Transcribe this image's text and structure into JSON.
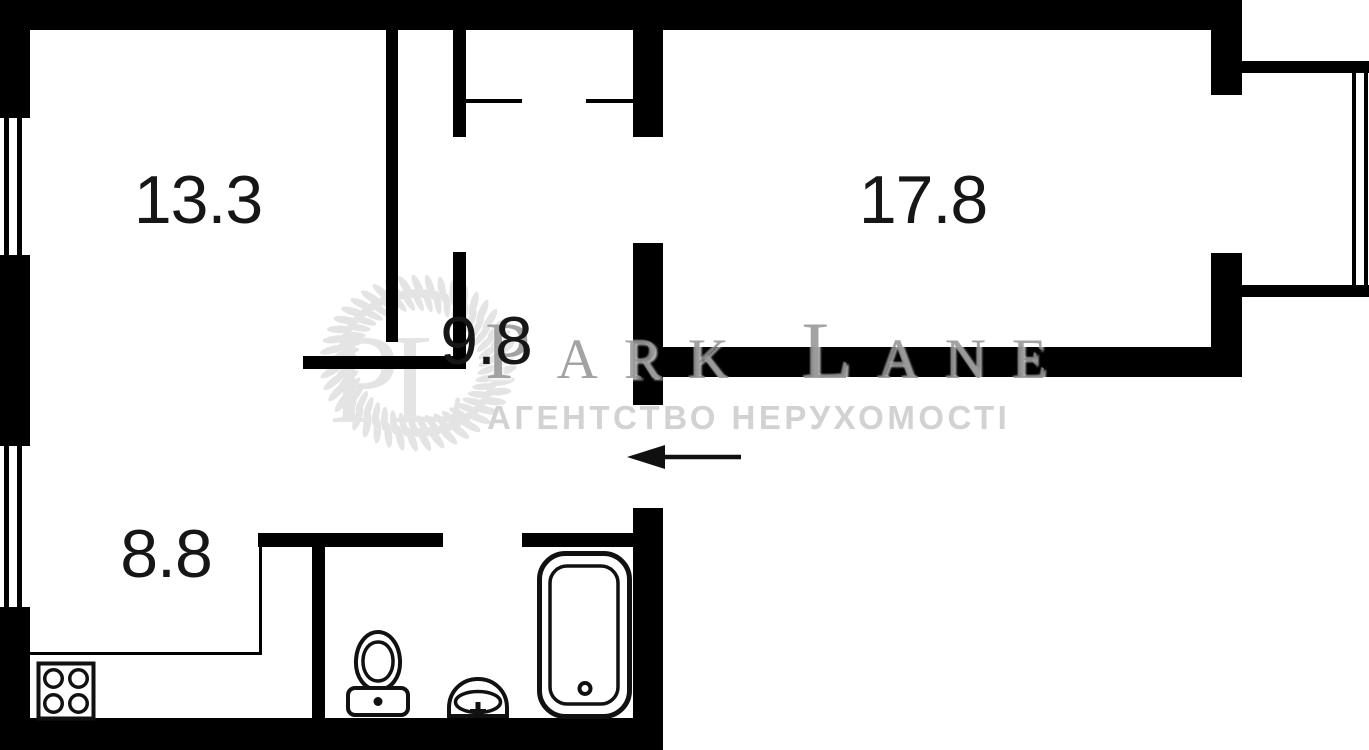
{
  "rooms": [
    {
      "id": "room-a",
      "area_label": "13.3"
    },
    {
      "id": "room-b",
      "area_label": "17.8"
    },
    {
      "id": "hallway",
      "area_label": "9.8"
    },
    {
      "id": "kitchen",
      "area_label": "8.8"
    }
  ],
  "watermark": {
    "monogram": "PL",
    "brand": "Park Lane",
    "tagline": "АГЕНТСТВО НЕРУХОМОСТІ"
  },
  "fixtures": {
    "kitchen": "stove-icon",
    "bathroom": [
      "toilet-icon",
      "sink-icon",
      "bathtub-icon"
    ],
    "exterior": "window-icon",
    "entrance": "entrance-arrow-icon"
  },
  "entrance": {
    "direction": "left"
  },
  "colors": {
    "background": "#ffffff",
    "walls": "#000000",
    "label_text": "#161616",
    "brand_watermark": "#9e9e9e",
    "tagline_watermark": "#d2d2d2",
    "wreath_watermark": "#e4e4e4"
  }
}
